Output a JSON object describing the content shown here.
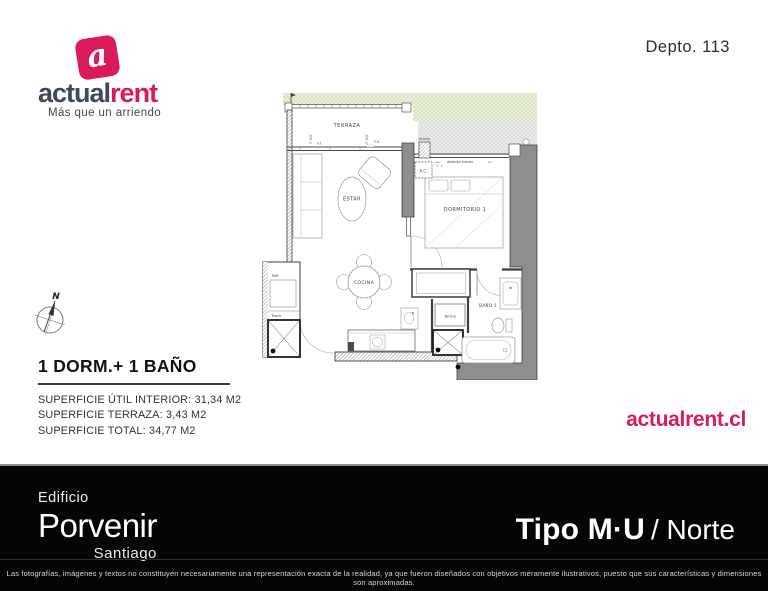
{
  "header": {
    "logo": {
      "icon_letter": "a",
      "brand_part1": "actual",
      "brand_part2": "rent",
      "tagline": "Más que un arriendo"
    },
    "unit_label": "Depto. 113"
  },
  "plan": {
    "rooms": {
      "terraza": "TERRAZA",
      "estar": "ESTAR",
      "dormitorio1": "DORMITORIO 1",
      "cocina": "COCINA",
      "bano1": "BAÑO 1"
    },
    "labels": {
      "ref": "Ref.",
      "rack": "Rack",
      "termo": "Termo",
      "ac": "A.C.",
      "ducto": "ducto",
      "aislacion": "Aislación Interior",
      "vf_a": "v.f.",
      "ve_a": "v.e.",
      "ve_b": "v.e.",
      "vf_b": "v.f.",
      "rail_a": "P. S/K",
      "rail_b": "P. S/K",
      "north": "N"
    }
  },
  "summary": {
    "title": "1 DORM.+ 1 BAÑO",
    "lines": [
      "SUPERFICIE ÚTIL INTERIOR: 31,34 M2",
      "SUPERFICIE TERRAZA: 3,43 M2",
      "SUPERFICIE TOTAL: 34,77 M2"
    ]
  },
  "website_url": "actualrent.cl",
  "footer": {
    "building_label": "Edificio",
    "building_name": "Porvenir",
    "building_city": "Santiago",
    "unit_type": "Tipo M·U",
    "unit_orientation": "/ Norte",
    "disclaimer": "Las fotografías, imágenes y textos no constituyen necesariamente una representación exacta de la realidad, ya que fueron diseñados con objetivos meramente ilustrativos, puesto que sus características y dimensiones son aproximadas."
  },
  "colors": {
    "accent": "#da1a5d",
    "navy": "#3e4a59",
    "footer_bg": "#050505"
  }
}
